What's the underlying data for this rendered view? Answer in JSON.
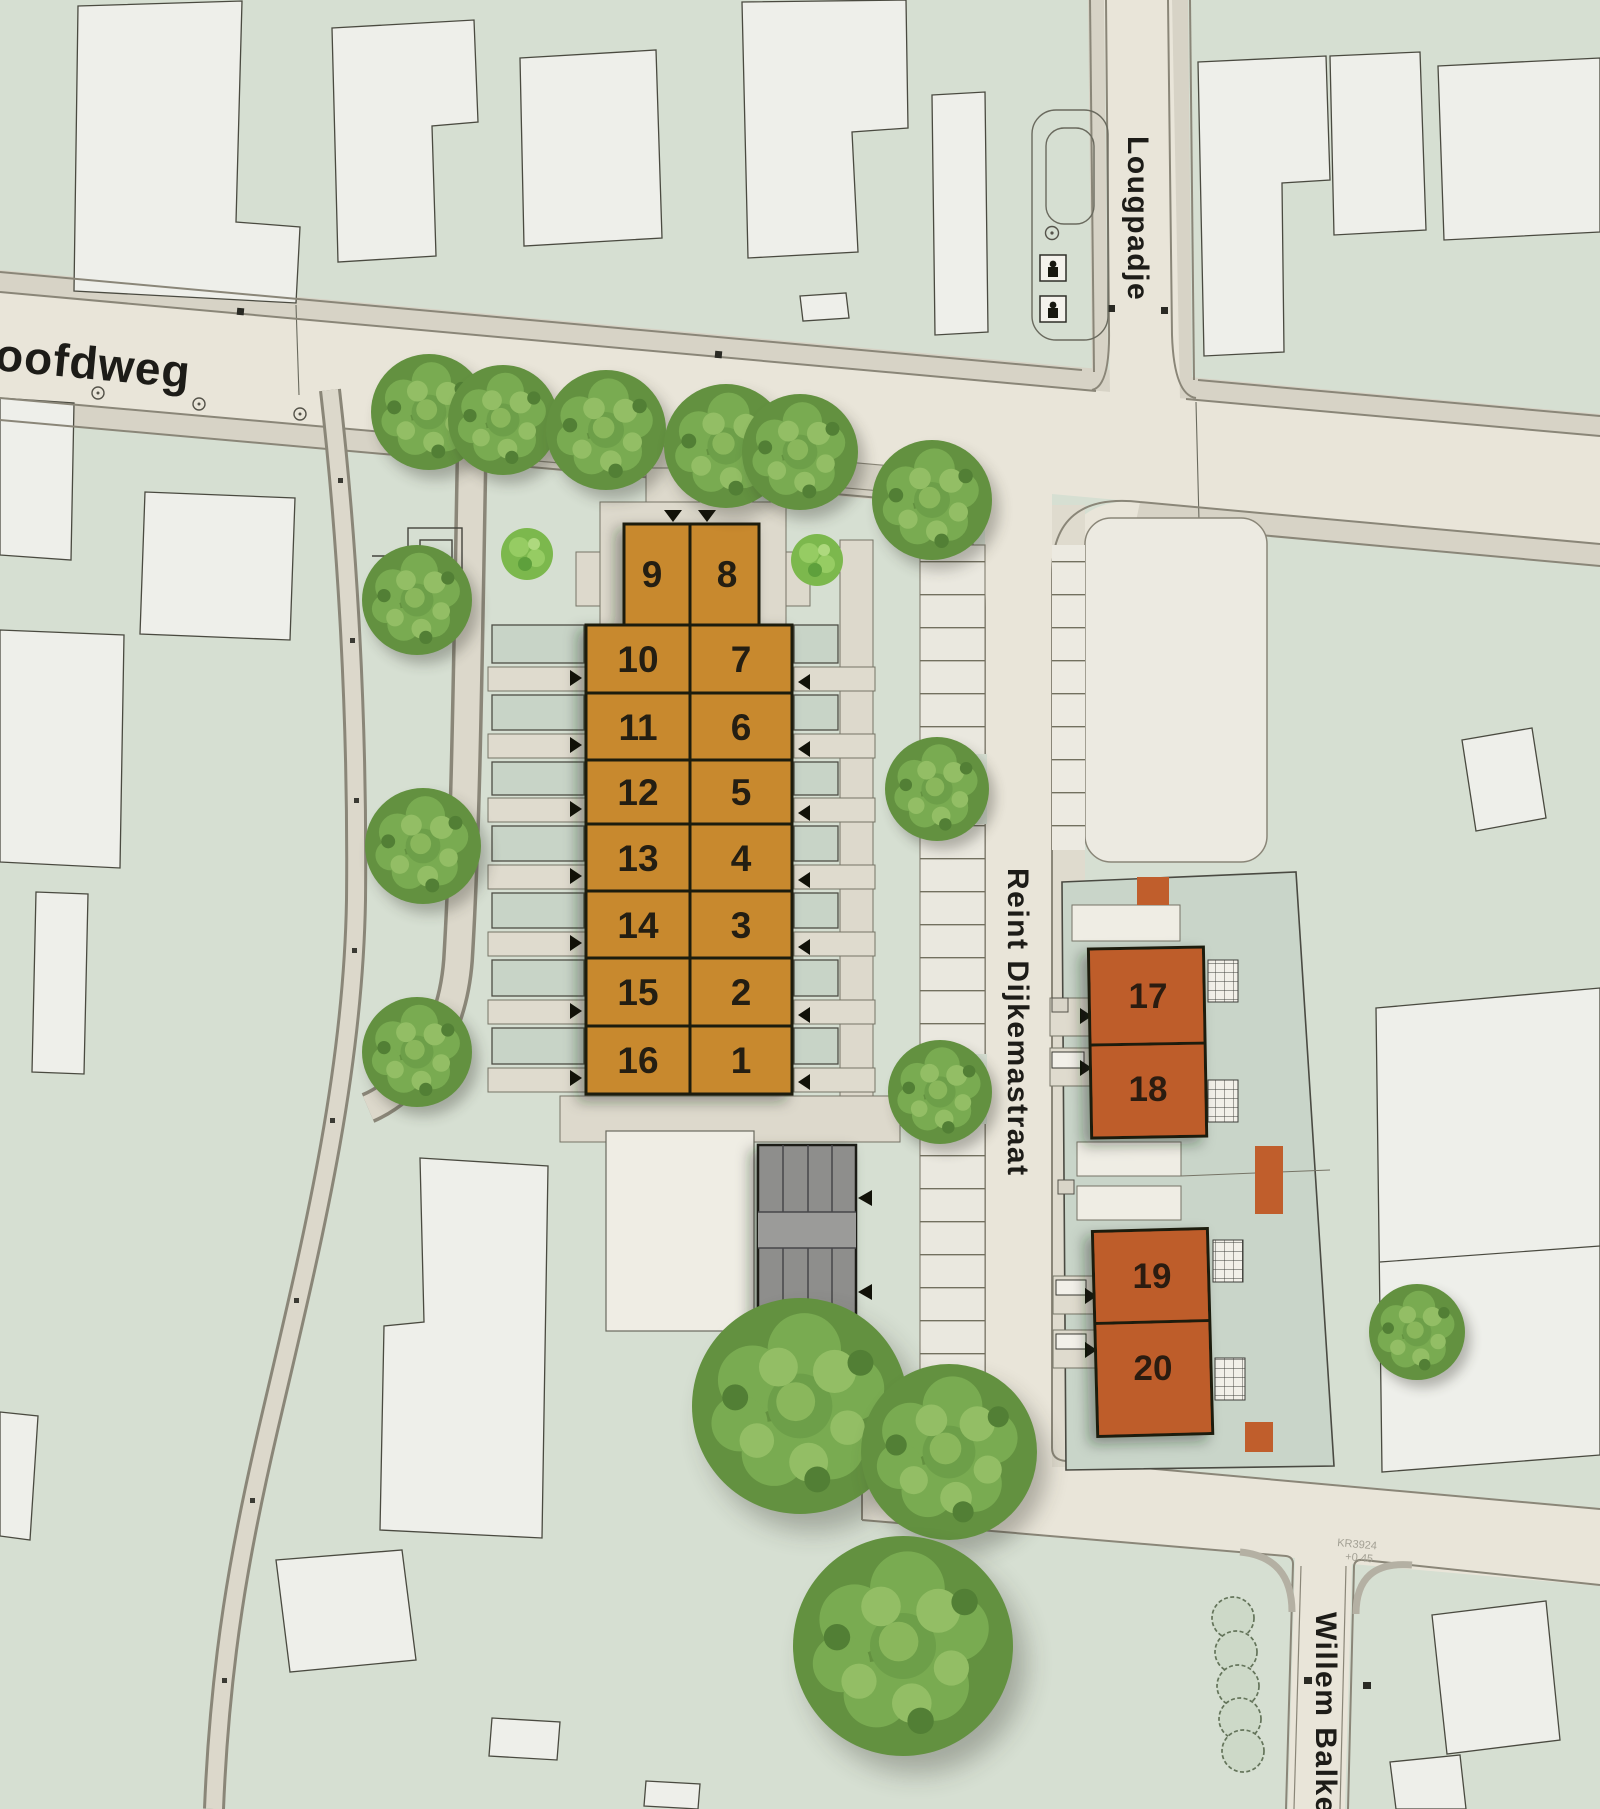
{
  "page": {
    "type": "residential-site-plan"
  },
  "streets": {
    "hoofdweg": "oofdweg",
    "lougpadje": "Lougpadje",
    "reint_dijkemastraat": "Reint Dijkemastraat",
    "willem_balkemastraat": "Willem Balkema"
  },
  "plots": {
    "p1": "1",
    "p2": "2",
    "p3": "3",
    "p4": "4",
    "p5": "5",
    "p6": "6",
    "p7": "7",
    "p8": "8",
    "p9": "9",
    "p10": "10",
    "p11": "11",
    "p12": "12",
    "p13": "13",
    "p14": "14",
    "p15": "15",
    "p16": "16",
    "p17": "17",
    "p18": "18",
    "p19": "19",
    "p20": "20"
  },
  "annotations": {
    "parcel_code": "KR3924",
    "elevation": "+0.45"
  },
  "colors": {
    "background": "#D6DFD2",
    "road": "#E9E5D9",
    "sidewalk": "#D7D3C6",
    "walkway": "#DDD9CC",
    "paved": "#ECEAE1",
    "plot_terraced": "#C8892F",
    "plot_detached": "#BE5D2C",
    "garage": "#8E8E8C",
    "tree": "#6FA14B",
    "outline": "#2A2A22"
  }
}
